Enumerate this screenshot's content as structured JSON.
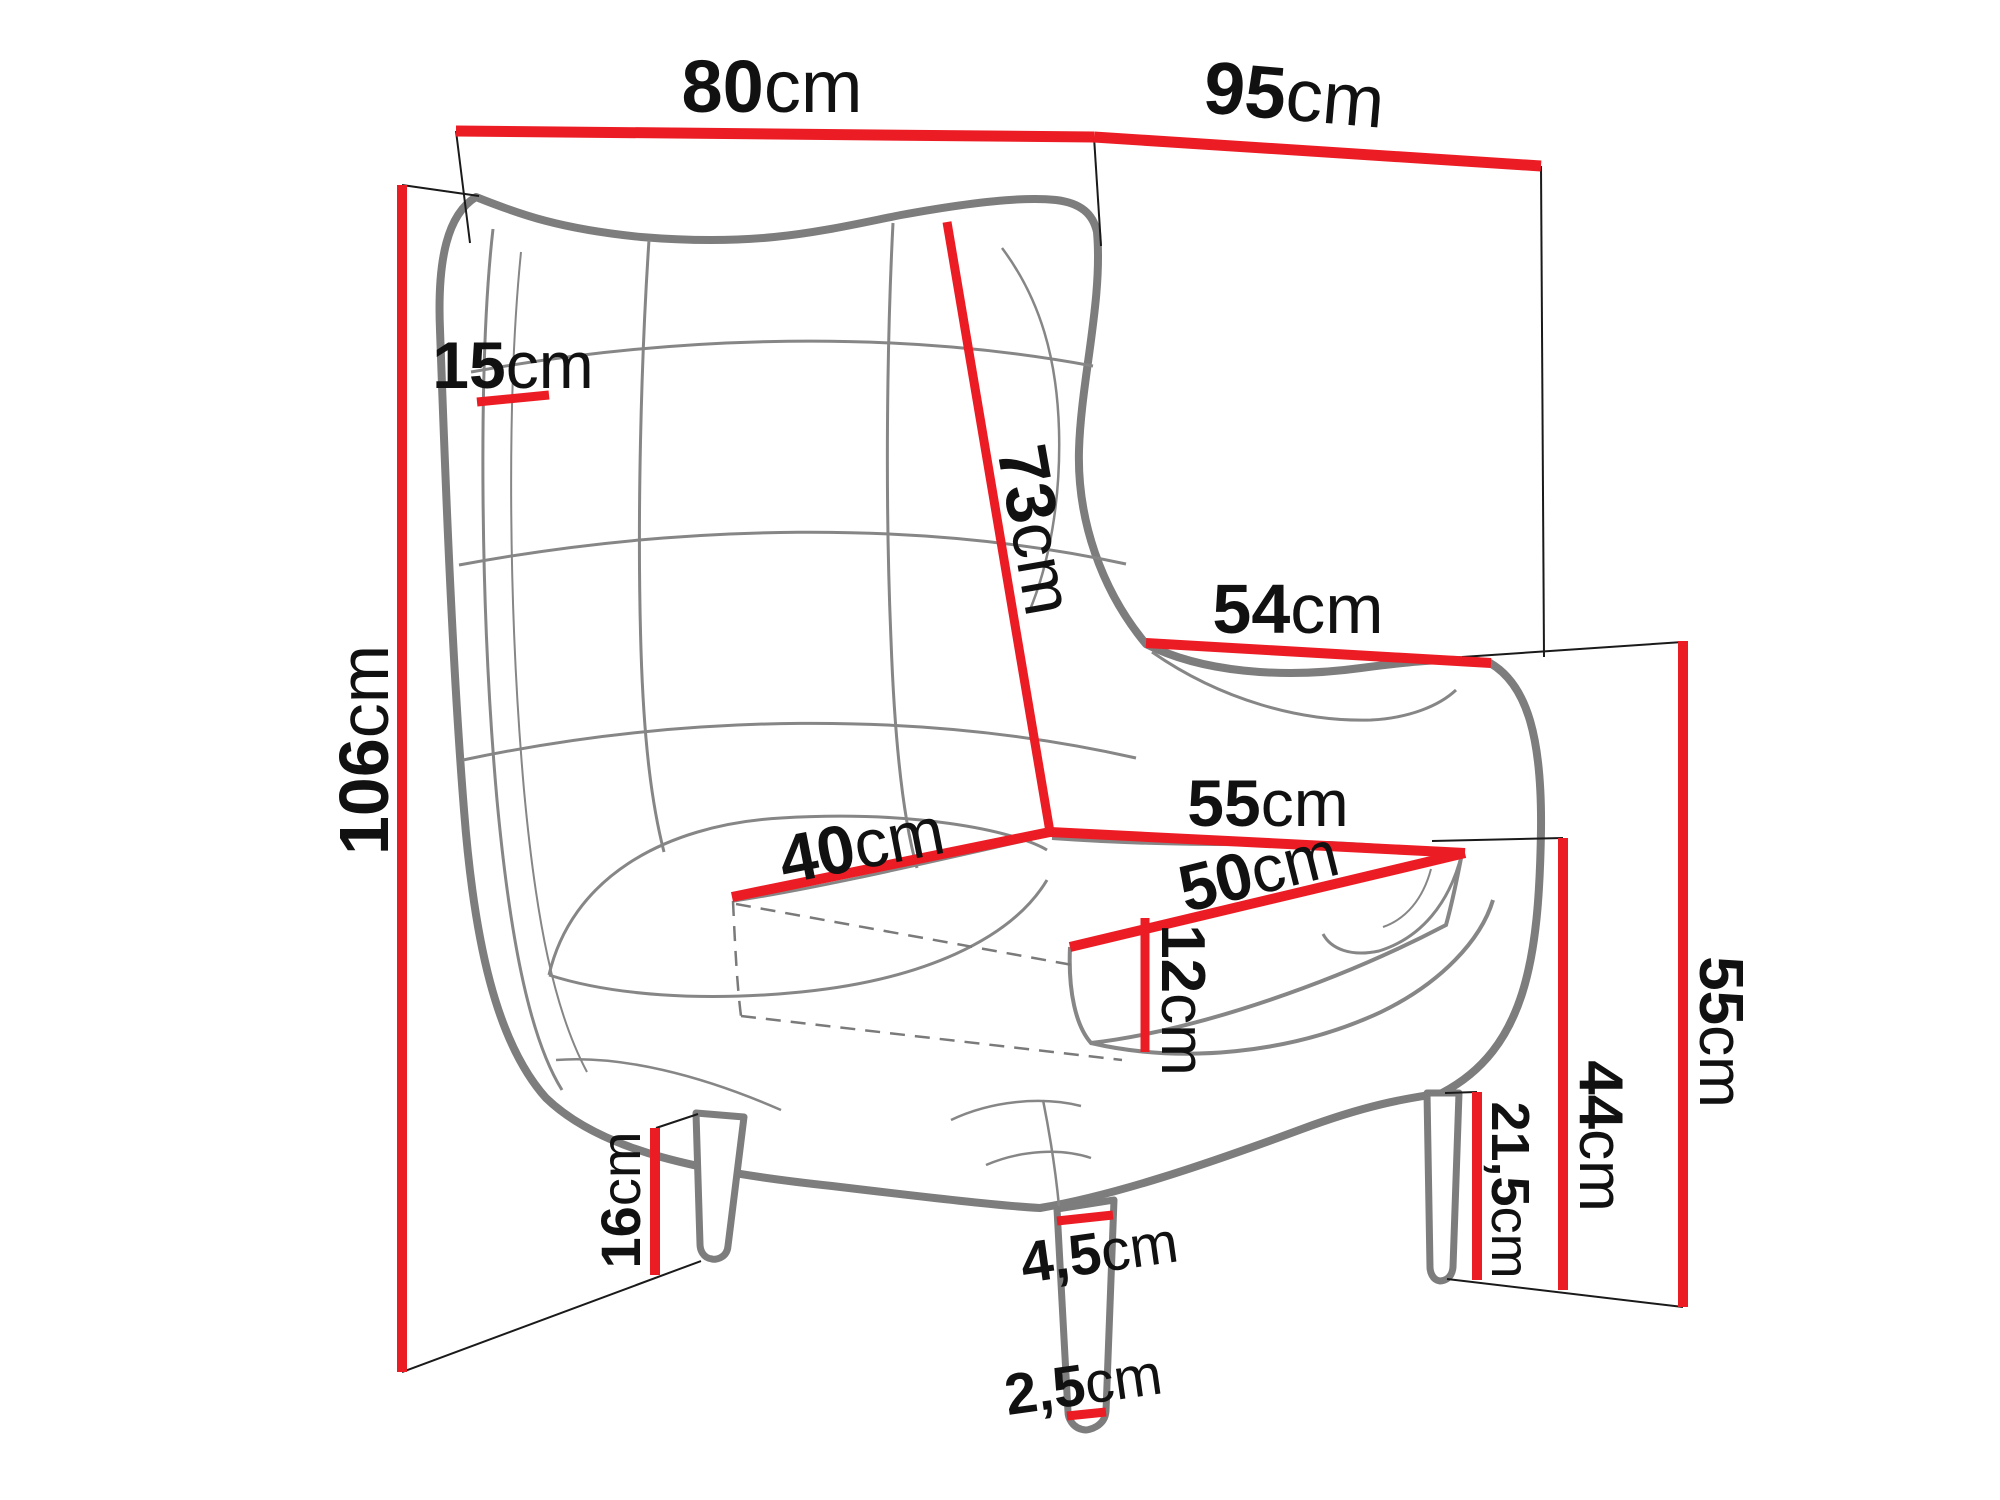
{
  "diagram": {
    "subject": "wingback-armchair-dimension-drawing",
    "unit_system": "cm",
    "accent_color": "#ec1c24",
    "chair_outline_color": "#7d7d7d",
    "extension_line_color": "#1a1a1a",
    "dims": {
      "overall_width": {
        "value": "80",
        "unit": "cm"
      },
      "overall_depth": {
        "value": "95",
        "unit": "cm"
      },
      "overall_height": {
        "value": "106",
        "unit": "cm"
      },
      "wing_thickness": {
        "value": "15",
        "unit": "cm"
      },
      "backrest_length": {
        "value": "73",
        "unit": "cm"
      },
      "armrest_length": {
        "value": "54",
        "unit": "cm"
      },
      "seat_depth_back": {
        "value": "40",
        "unit": "cm"
      },
      "seat_width": {
        "value": "55",
        "unit": "cm"
      },
      "seat_depth_front": {
        "value": "50",
        "unit": "cm"
      },
      "cushion_thickness": {
        "value": "12",
        "unit": "cm"
      },
      "armrest_height": {
        "value": "55",
        "unit": "cm"
      },
      "seat_height": {
        "value": "44",
        "unit": "cm"
      },
      "rear_leg_height": {
        "value": "21,5",
        "unit": "cm"
      },
      "front_leg_height": {
        "value": "16",
        "unit": "cm"
      },
      "leg_top_width": {
        "value": "4,5",
        "unit": "cm"
      },
      "leg_bottom_width": {
        "value": "2,5",
        "unit": "cm"
      }
    }
  }
}
